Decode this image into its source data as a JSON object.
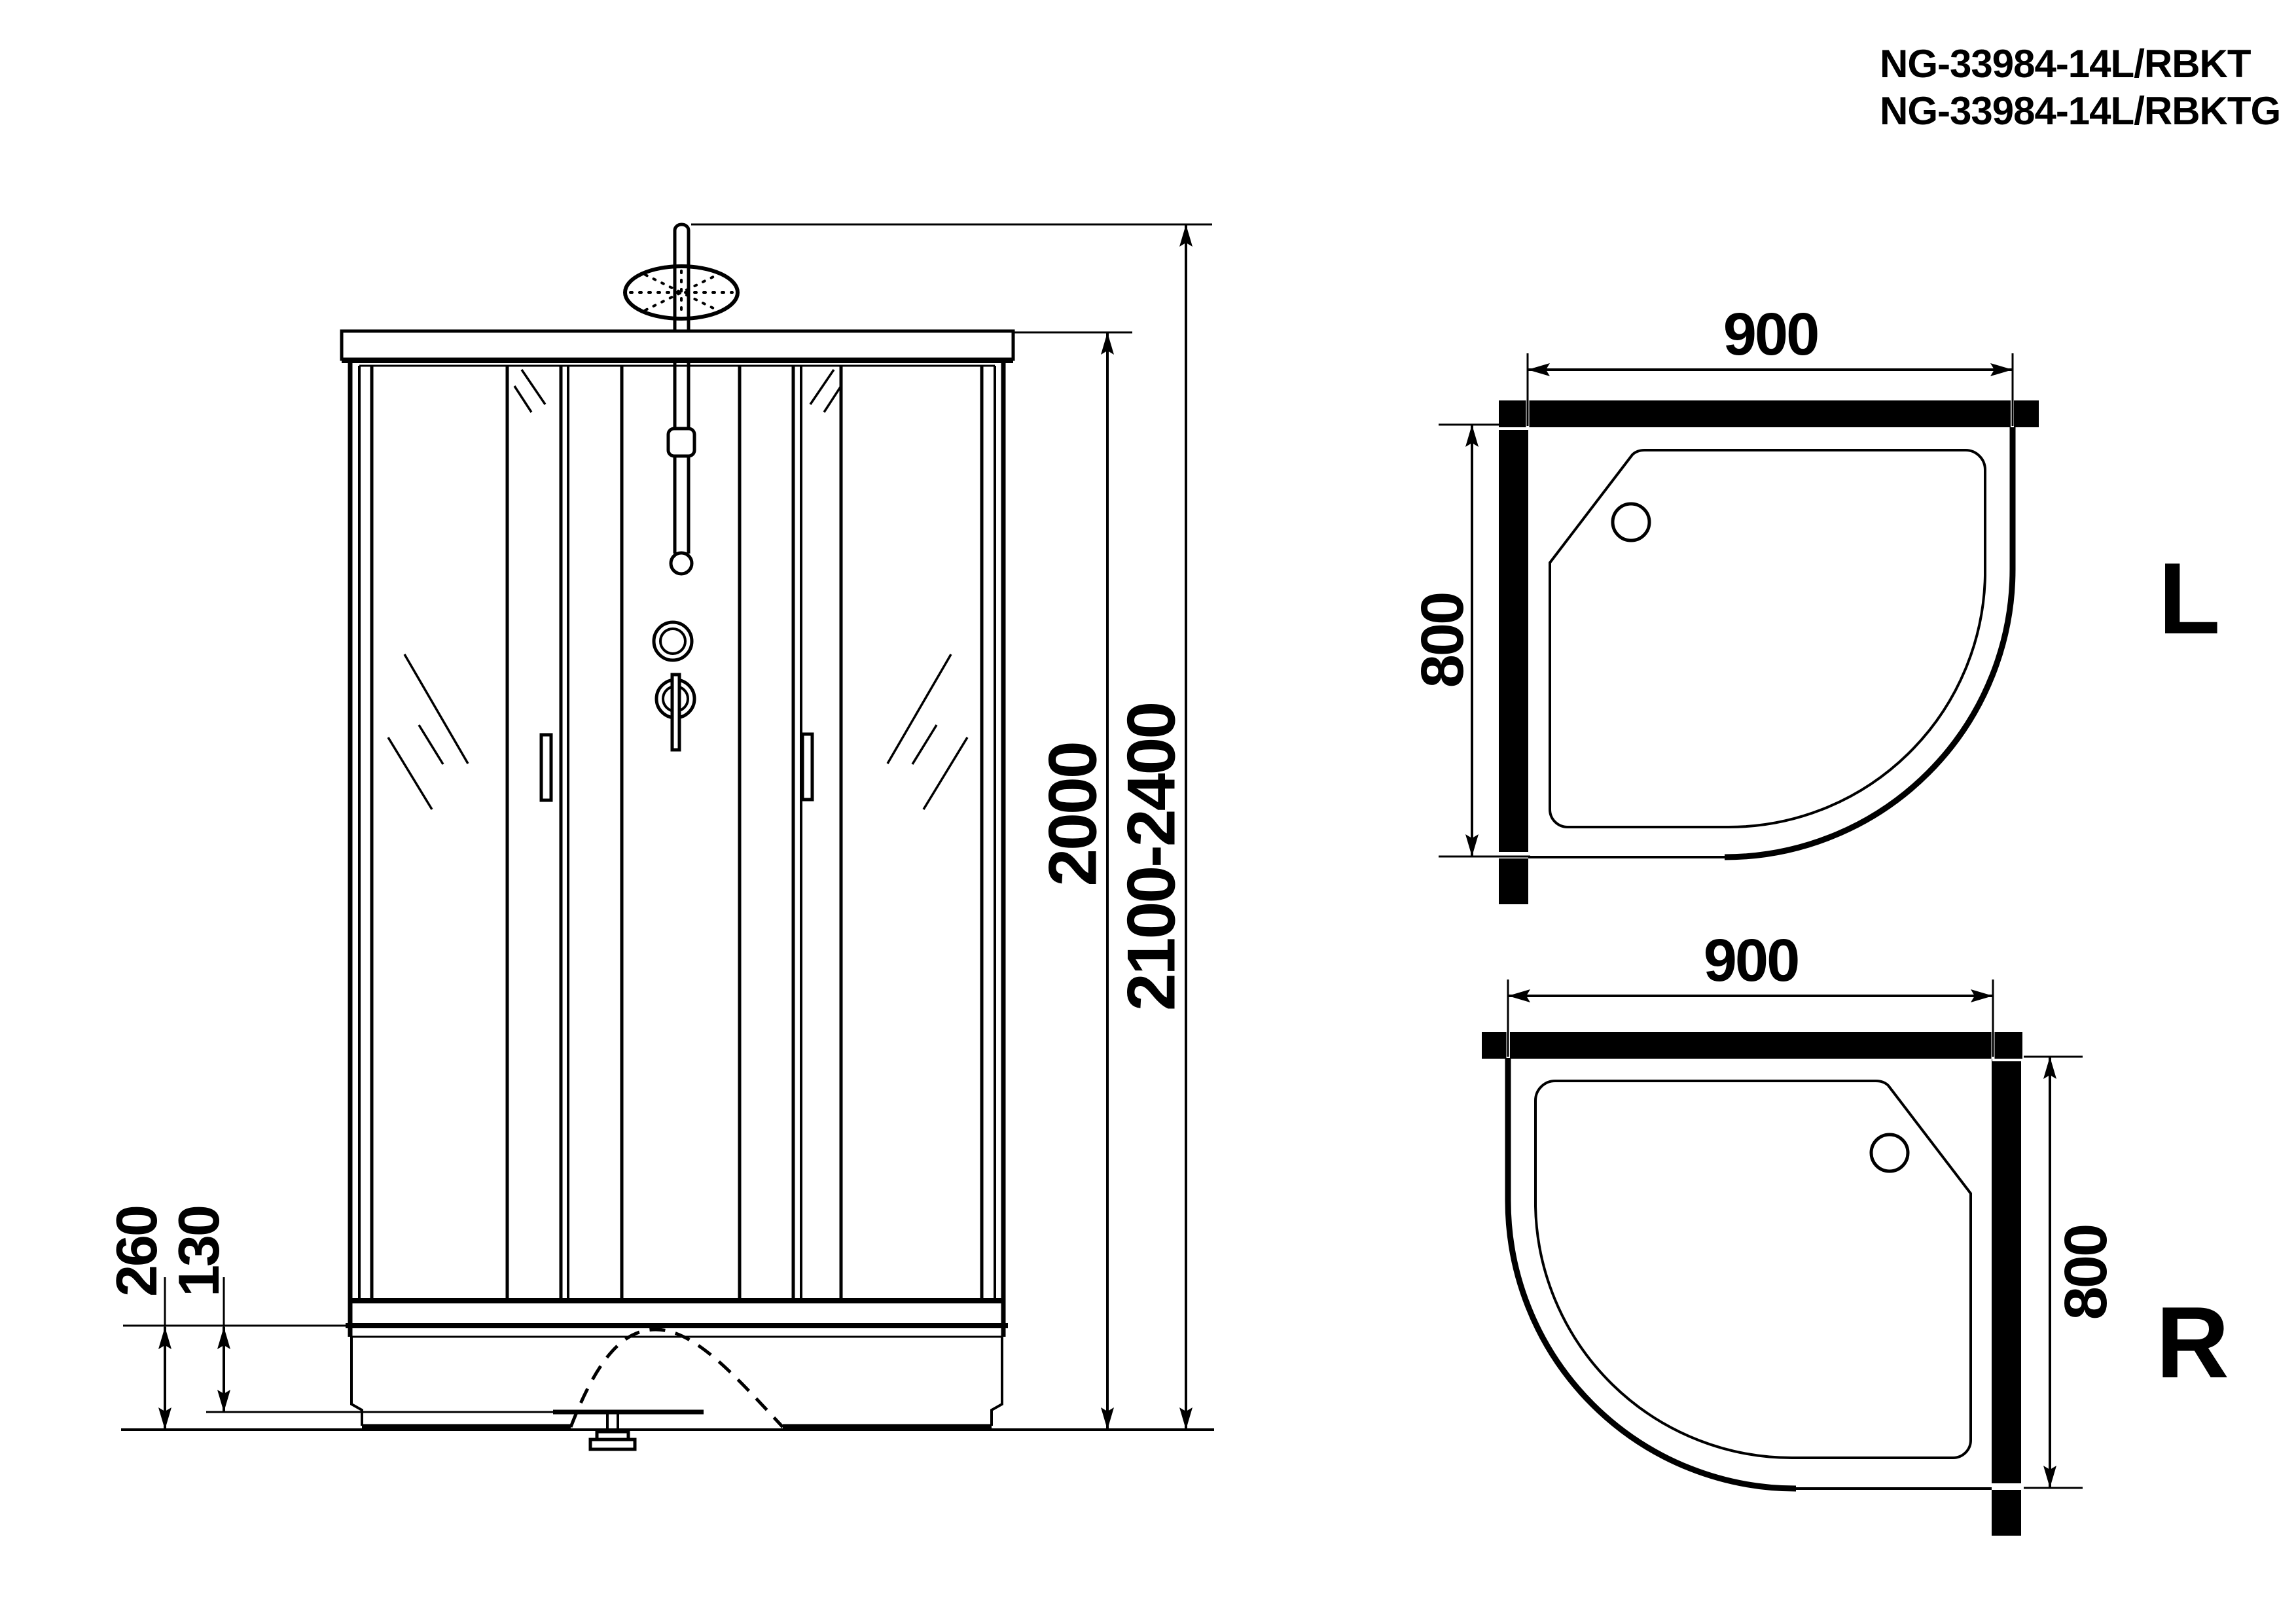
{
  "page": {
    "background": "#ffffff",
    "line_color": "#000000"
  },
  "header": {
    "model_line1": "NG-33984-14L/RBKT",
    "model_line2": "NG-33984-14L/RBKTG"
  },
  "front_view": {
    "inner_height": "2000",
    "total_height": "2100-2400",
    "base_height": "260",
    "base_half_height": "130"
  },
  "plan_l": {
    "width": "900",
    "depth": "800",
    "label": "L"
  },
  "plan_r": {
    "width": "900",
    "depth": "800",
    "label": "R"
  }
}
